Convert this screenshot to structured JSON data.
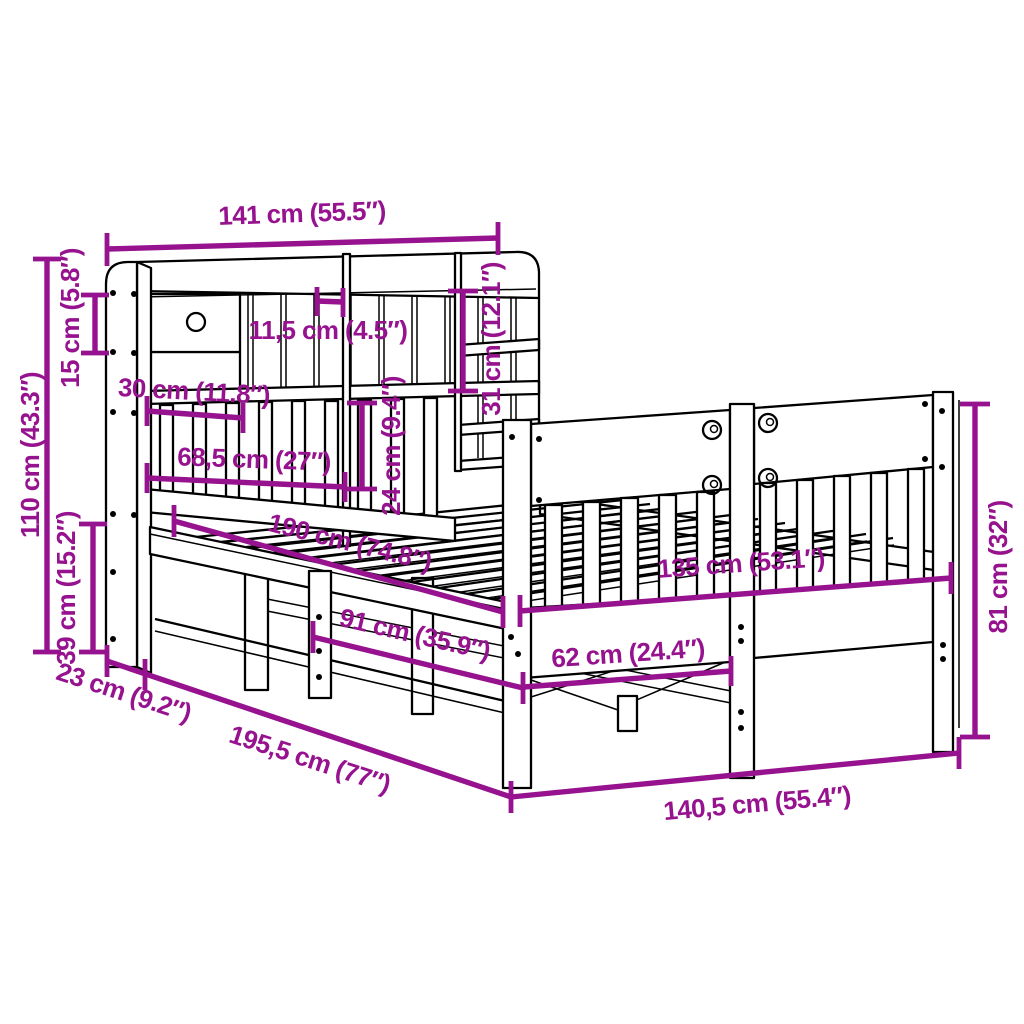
{
  "page": {
    "background_color": "#ffffff",
    "diagram_type": "product dimension diagram",
    "subject": "wooden bed frame with bookcase headboard, drawer and slatted footboard"
  },
  "style": {
    "dimension_color": "#96128e",
    "art_line_color": "#000000"
  },
  "dimensions": {
    "headboard_width": {
      "label": "141 cm (55.5″)",
      "cm": 141,
      "inches": 55.5,
      "orientation": "horizontal"
    },
    "drawer_height": {
      "label": "15 cm (5.8″)",
      "cm": 15,
      "inches": 5.8,
      "orientation": "vertical"
    },
    "headboard_height": {
      "label": "110 cm (43.3″)",
      "cm": 110,
      "inches": 43.3,
      "orientation": "vertical"
    },
    "base_height": {
      "label": "39 cm (15.2″)",
      "cm": 39,
      "inches": 15.2,
      "orientation": "vertical"
    },
    "drawer_width": {
      "label": "30 cm (11.8″)",
      "cm": 30,
      "inches": 11.8,
      "orientation": "horizontal"
    },
    "compartment_width": {
      "label": "11,5 cm (4.5″)",
      "cm": 11.5,
      "inches": 4.5,
      "orientation": "horizontal"
    },
    "shelf_row_height": {
      "label": "31 cm (12.1″)",
      "cm": 31,
      "inches": 12.1,
      "orientation": "vertical"
    },
    "slat_panel_width": {
      "label": "68,5 cm (27″)",
      "cm": 68.5,
      "inches": 27,
      "orientation": "horizontal"
    },
    "slat_panel_height": {
      "label": "24 cm (9.4″)",
      "cm": 24,
      "inches": 9.4,
      "orientation": "vertical"
    },
    "bed_length_inner": {
      "label": "190 cm (74.8″)",
      "cm": 190,
      "inches": 74.8,
      "orientation": "diagonal"
    },
    "underbed_length": {
      "label": "91 cm (35.9″)",
      "cm": 91,
      "inches": 35.9,
      "orientation": "diagonal"
    },
    "bed_width_inner": {
      "label": "135 cm (53.1″)",
      "cm": 135,
      "inches": 53.1,
      "orientation": "diagonal"
    },
    "footboard_leg_gap": {
      "label": "62 cm (24.4″)",
      "cm": 62,
      "inches": 24.4,
      "orientation": "diagonal"
    },
    "headboard_depth": {
      "label": "23 cm (9.2″)",
      "cm": 23,
      "inches": 9.2,
      "orientation": "diagonal"
    },
    "total_length": {
      "label": "195,5 cm (77″)",
      "cm": 195.5,
      "inches": 77,
      "orientation": "diagonal"
    },
    "total_width": {
      "label": "140,5 cm (55.4″)",
      "cm": 140.5,
      "inches": 55.4,
      "orientation": "diagonal"
    },
    "footboard_height": {
      "label": "81 cm (32″)",
      "cm": 81,
      "inches": 32,
      "orientation": "vertical"
    }
  }
}
